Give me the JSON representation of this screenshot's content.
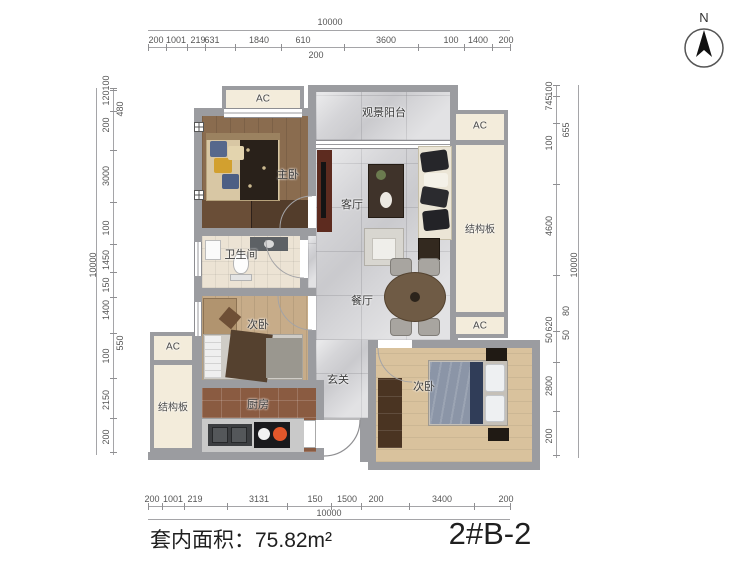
{
  "title_block": {
    "area_label": "套内面积：75.82m²",
    "unit_number": "2#B-2"
  },
  "compass": {
    "label": "N"
  },
  "room_labels": {
    "master_bedroom": "主卧",
    "bathroom": "卫生间",
    "second_bedroom_left": "次卧",
    "kitchen": "厨房",
    "living_room": "客厅",
    "dining_room": "餐厅",
    "balcony": "观景阳台",
    "entry_hall": "玄关",
    "second_bedroom_right": "次卧",
    "structural_panel": "结构板",
    "ac_unit": "AC"
  },
  "dimensions": {
    "top": {
      "overall": "10000",
      "segments": [
        "200",
        "1001",
        "219",
        "631",
        "1840",
        "610",
        "3600",
        "100",
        "1400",
        "200"
      ],
      "sub_segment": "200"
    },
    "bottom": {
      "overall": "10000",
      "segments": [
        "200",
        "1001",
        "219",
        "3131",
        "150",
        "1500",
        "200",
        "3400",
        "200"
      ]
    },
    "left": {
      "overall": "10000",
      "segments": [
        "100",
        "120",
        "200",
        "3000",
        "100",
        "1450",
        "150",
        "1400",
        "100",
        "2150",
        "200"
      ],
      "inner": [
        "480",
        "550"
      ]
    },
    "right": {
      "overall": "10000",
      "segments": [
        "100",
        "745",
        "100",
        "4600",
        "620",
        "50",
        "2800",
        "200"
      ],
      "inner": [
        "655",
        "80",
        "50"
      ]
    }
  }
}
